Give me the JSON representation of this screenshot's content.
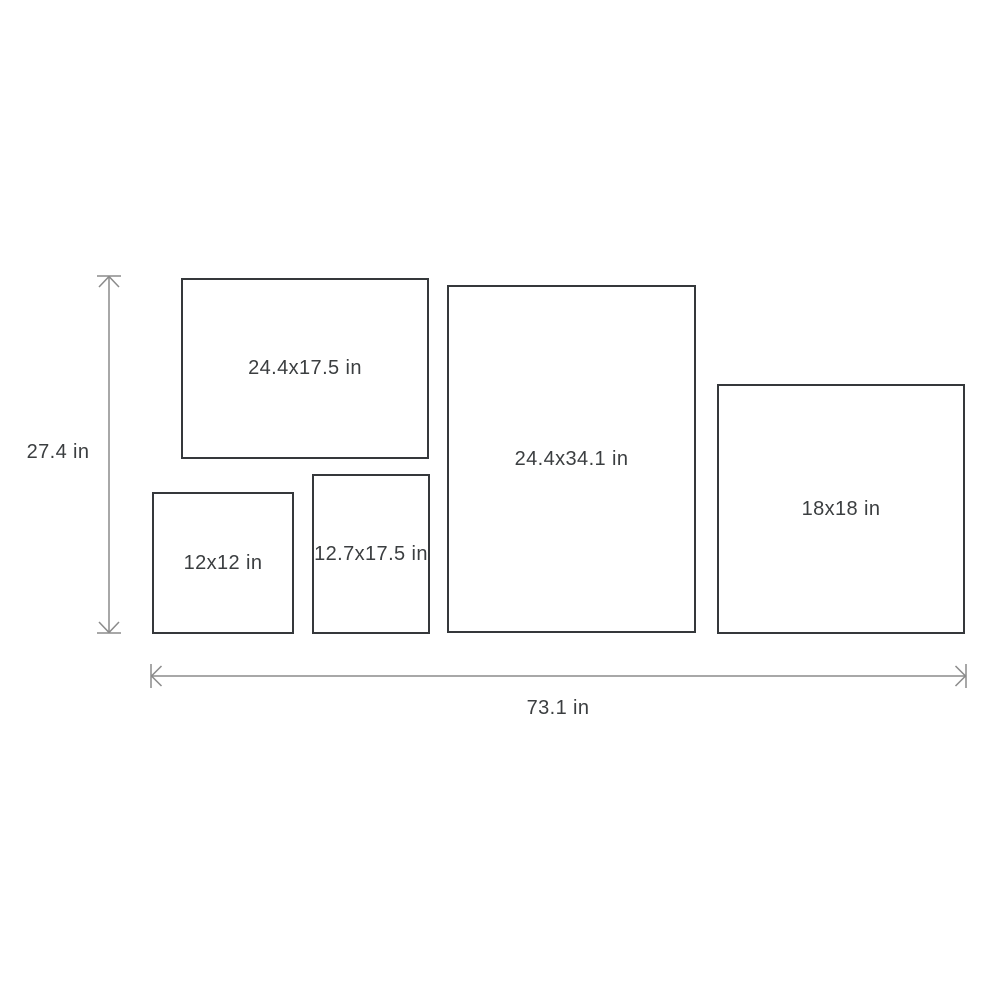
{
  "colors": {
    "background": "#ffffff",
    "frame_border": "#35383b",
    "label_text": "#3b3e40",
    "dimension_arrow": "#8b8b8b"
  },
  "overall_dimensions": {
    "height": {
      "label": "27.4 in",
      "value_in": 27.4
    },
    "width": {
      "label": "73.1 in",
      "value_in": 73.1
    }
  },
  "frames": [
    {
      "label": "24.4x17.5 in",
      "width_in": 24.4,
      "height_in": 17.5
    },
    {
      "label": "12x12 in",
      "width_in": 12,
      "height_in": 12
    },
    {
      "label": "12.7x17.5 in",
      "width_in": 12.7,
      "height_in": 17.5
    },
    {
      "label": "24.4x34.1 in",
      "width_in": 24.4,
      "height_in": 34.1
    },
    {
      "label": "18x18 in",
      "width_in": 18,
      "height_in": 18
    }
  ]
}
